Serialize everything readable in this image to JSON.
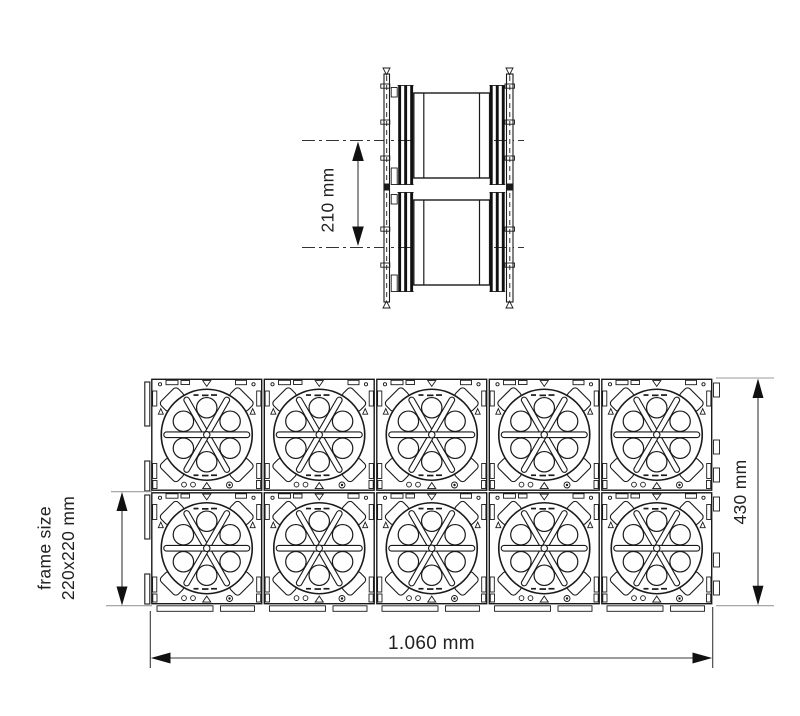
{
  "drawing": {
    "background": "#ffffff",
    "side_view": {
      "units": 2,
      "center_spacing_label": "210 mm"
    },
    "front_view": {
      "rows": 2,
      "columns": 5,
      "module_count": 10,
      "frame_size_label_line1": "frame size",
      "frame_size_label_line2": "220x220 mm",
      "overall_height_label": "430 mm",
      "overall_width_label": "1.060 mm"
    },
    "colors": {
      "line": "#1a1a1a",
      "dimension_line": "#3a3a3a",
      "extension_line": "#9b9b9b",
      "text": "#222222",
      "background": "#ffffff"
    }
  }
}
